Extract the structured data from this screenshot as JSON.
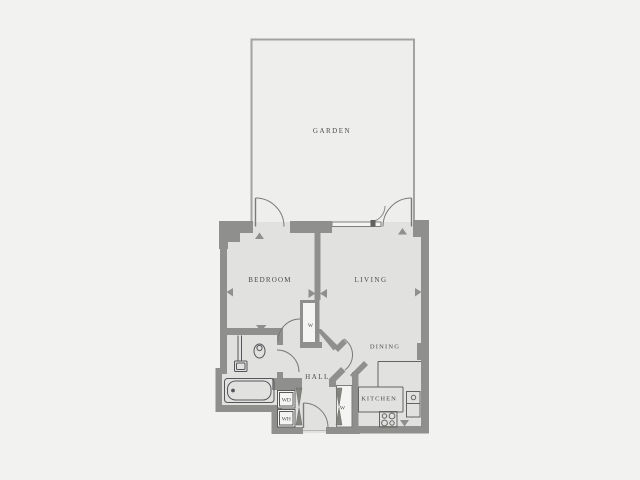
{
  "floorplan": {
    "title": "one-bedroom flat floor plan",
    "rooms": {
      "garden": {
        "label": "GARDEN"
      },
      "bedroom": {
        "label": "BEDROOM"
      },
      "living": {
        "label": "LIVING"
      },
      "dining": {
        "label": "DINING"
      },
      "kitchen": {
        "label": "KITCHEN"
      },
      "hall": {
        "label": "HALL"
      }
    },
    "closets": {
      "hall_wardrobe": {
        "label": "W"
      },
      "entry_wardrobe": {
        "label": "W"
      }
    },
    "appliances": {
      "washer_dryer": {
        "label": "WD"
      },
      "water_heater": {
        "label": "WH"
      }
    },
    "colors": {
      "background": "#f2f2f0",
      "floor": "#e1e1e0",
      "garden_floor": "#eeeeec",
      "garden_wall": "#a3a3a1",
      "wall": "#8f8f8d",
      "fixture_line": "#55555a",
      "door_line": "#7a7a78",
      "text": "#4b4b49",
      "closet_interior": "#f4f4f2"
    }
  }
}
